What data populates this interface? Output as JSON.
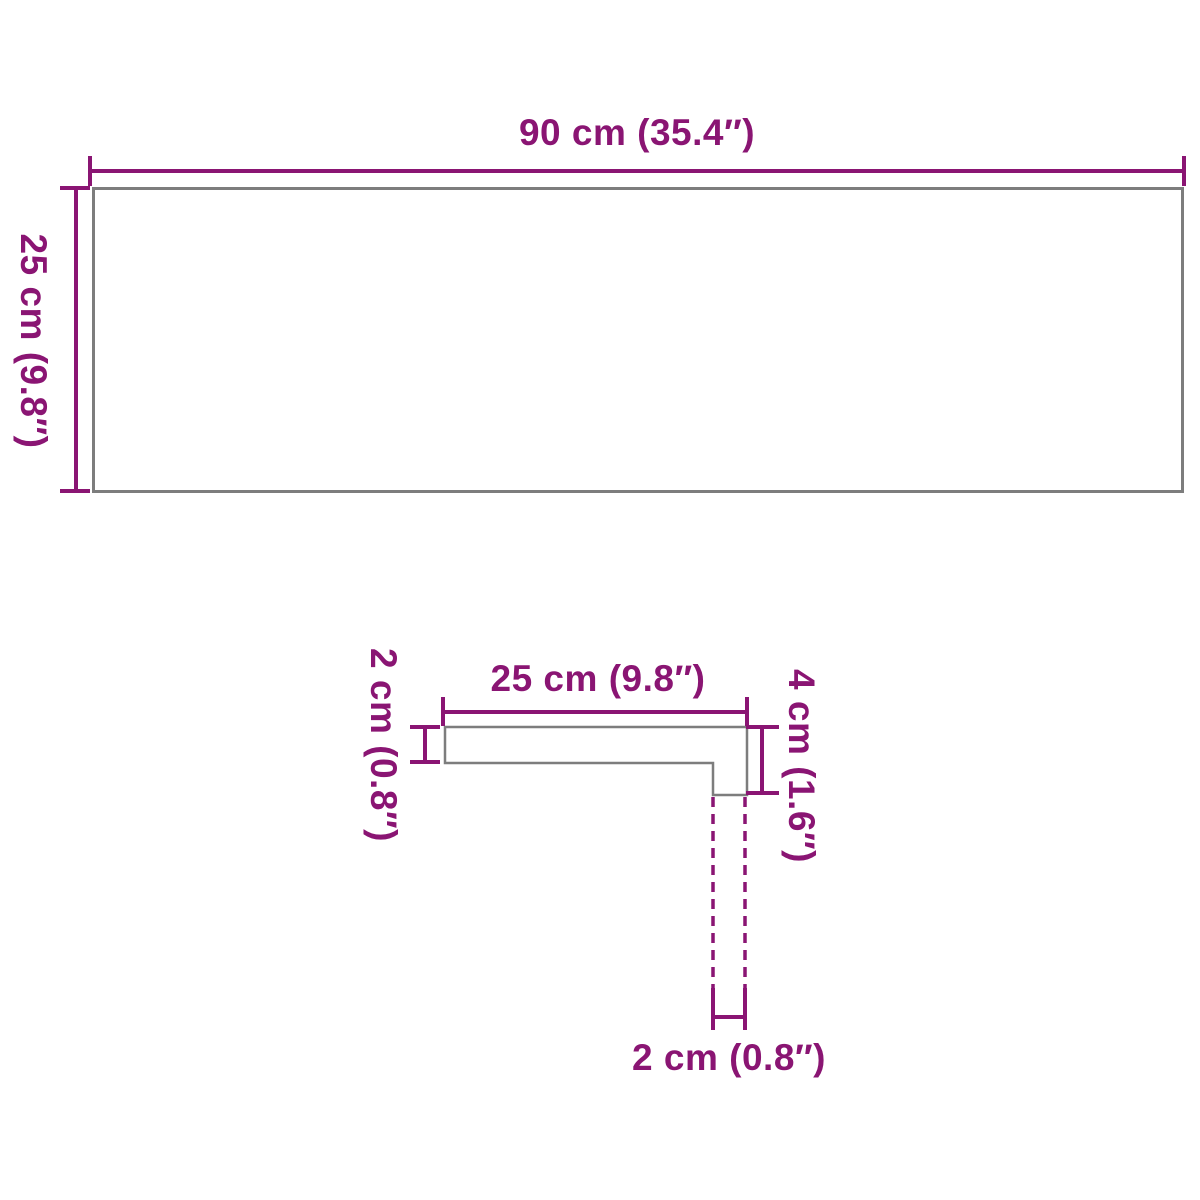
{
  "colors": {
    "accent": "#8a1573",
    "outline": "#7d7d7d",
    "background": "#ffffff"
  },
  "top_view": {
    "width_label": "90 cm (35.4″)",
    "depth_label": "25 cm (9.8″)"
  },
  "profile_view": {
    "tread_depth_label": "25 cm (9.8″)",
    "board_thickness_label": "2 cm (0.8″)",
    "nosing_height_label": "4 cm (1.6″)",
    "nosing_thickness_label": "2 cm (0.8″)"
  }
}
